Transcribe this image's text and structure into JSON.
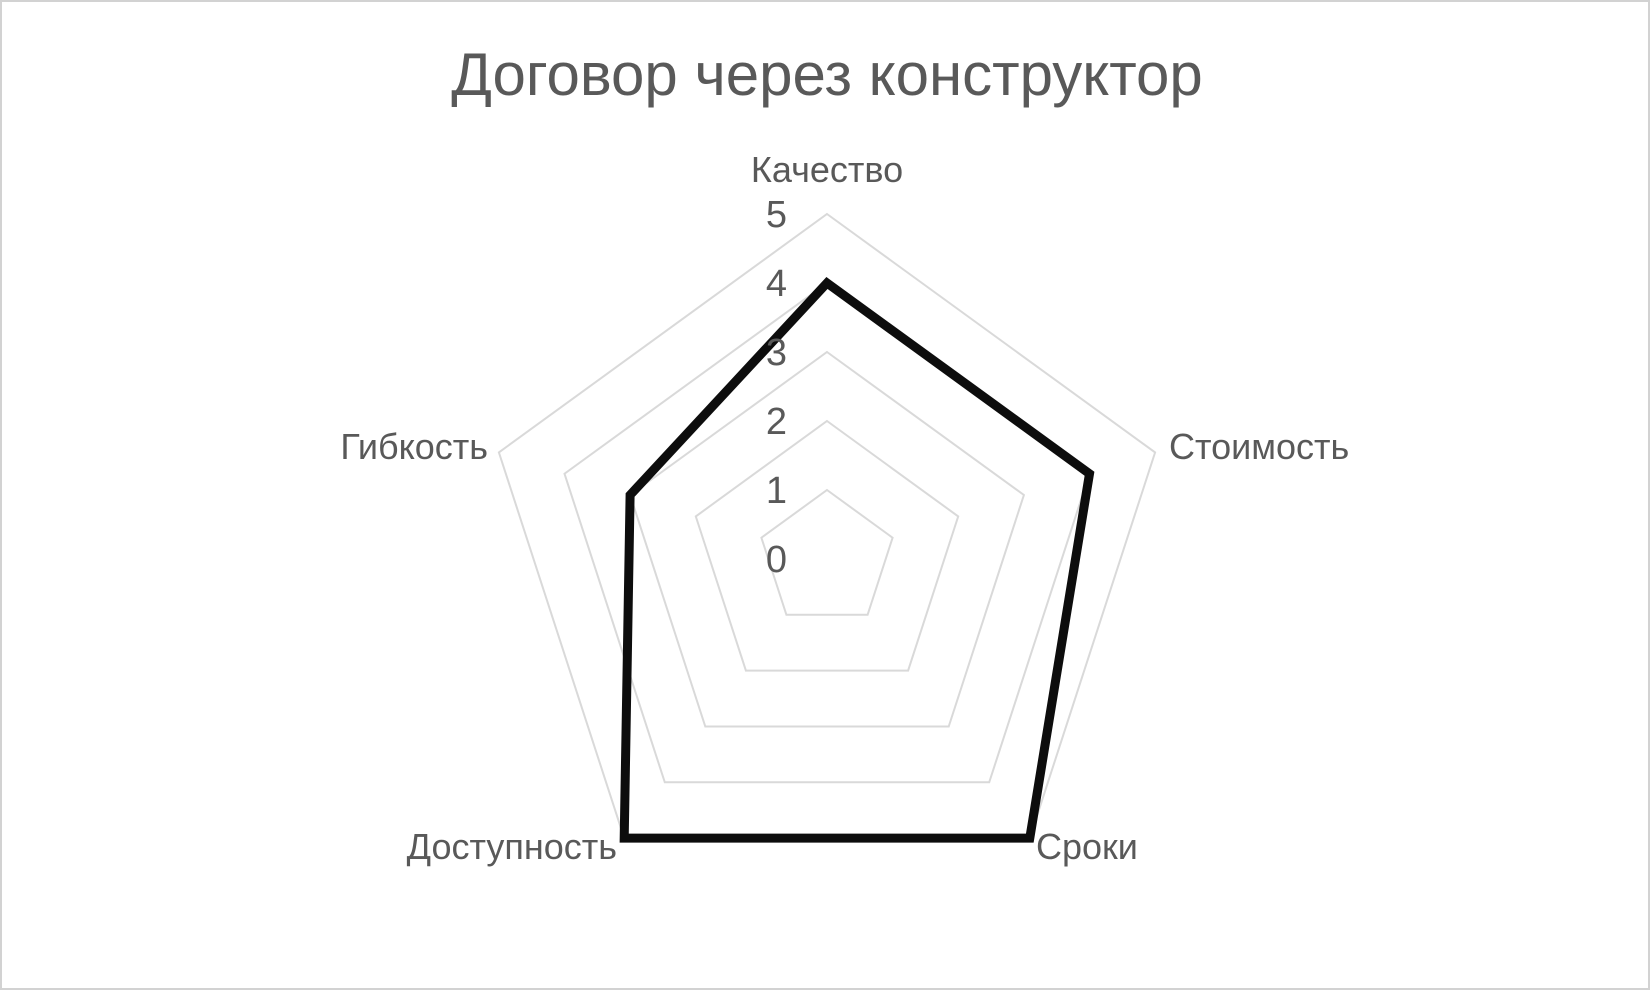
{
  "page": {
    "background": "#ffffff",
    "border_color": "#d2d2d2"
  },
  "chart_data": {
    "type": "radar",
    "title": "Договор через конструктор",
    "categories": [
      "Качество",
      "Стоимость",
      "Сроки",
      "Доступность",
      "Гибкость"
    ],
    "values": [
      4,
      4,
      5,
      5,
      3
    ],
    "ticks": [
      "0",
      "1",
      "2",
      "3",
      "4",
      "5"
    ],
    "axis_range": [
      0,
      5
    ],
    "grid": "on",
    "legend": "none",
    "colors": {
      "title": "#595959",
      "labels": "#595959",
      "gridlines": "#d9d9d9",
      "series": "#0d0d0d"
    }
  }
}
